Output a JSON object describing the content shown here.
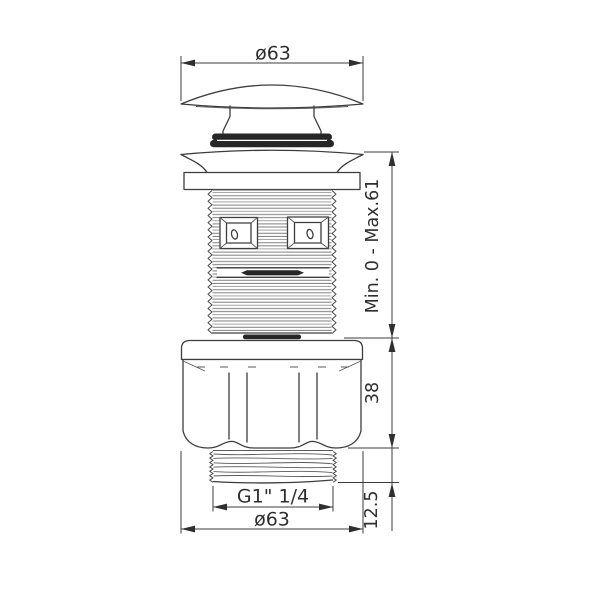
{
  "labels": {
    "top_diameter": "ø63",
    "height_range": "Min. 0 - Max.61",
    "nut_height": "38",
    "bottom_thread_length": "12.5",
    "thread_spec": "G1\" 1/4",
    "bottom_diameter": "ø63"
  },
  "colors": {
    "background": "#ffffff",
    "line": "#3d3d3d",
    "thread_hatch": "#8b8b8b",
    "dark_fill": "#262626",
    "text": "#2f2f2f"
  }
}
